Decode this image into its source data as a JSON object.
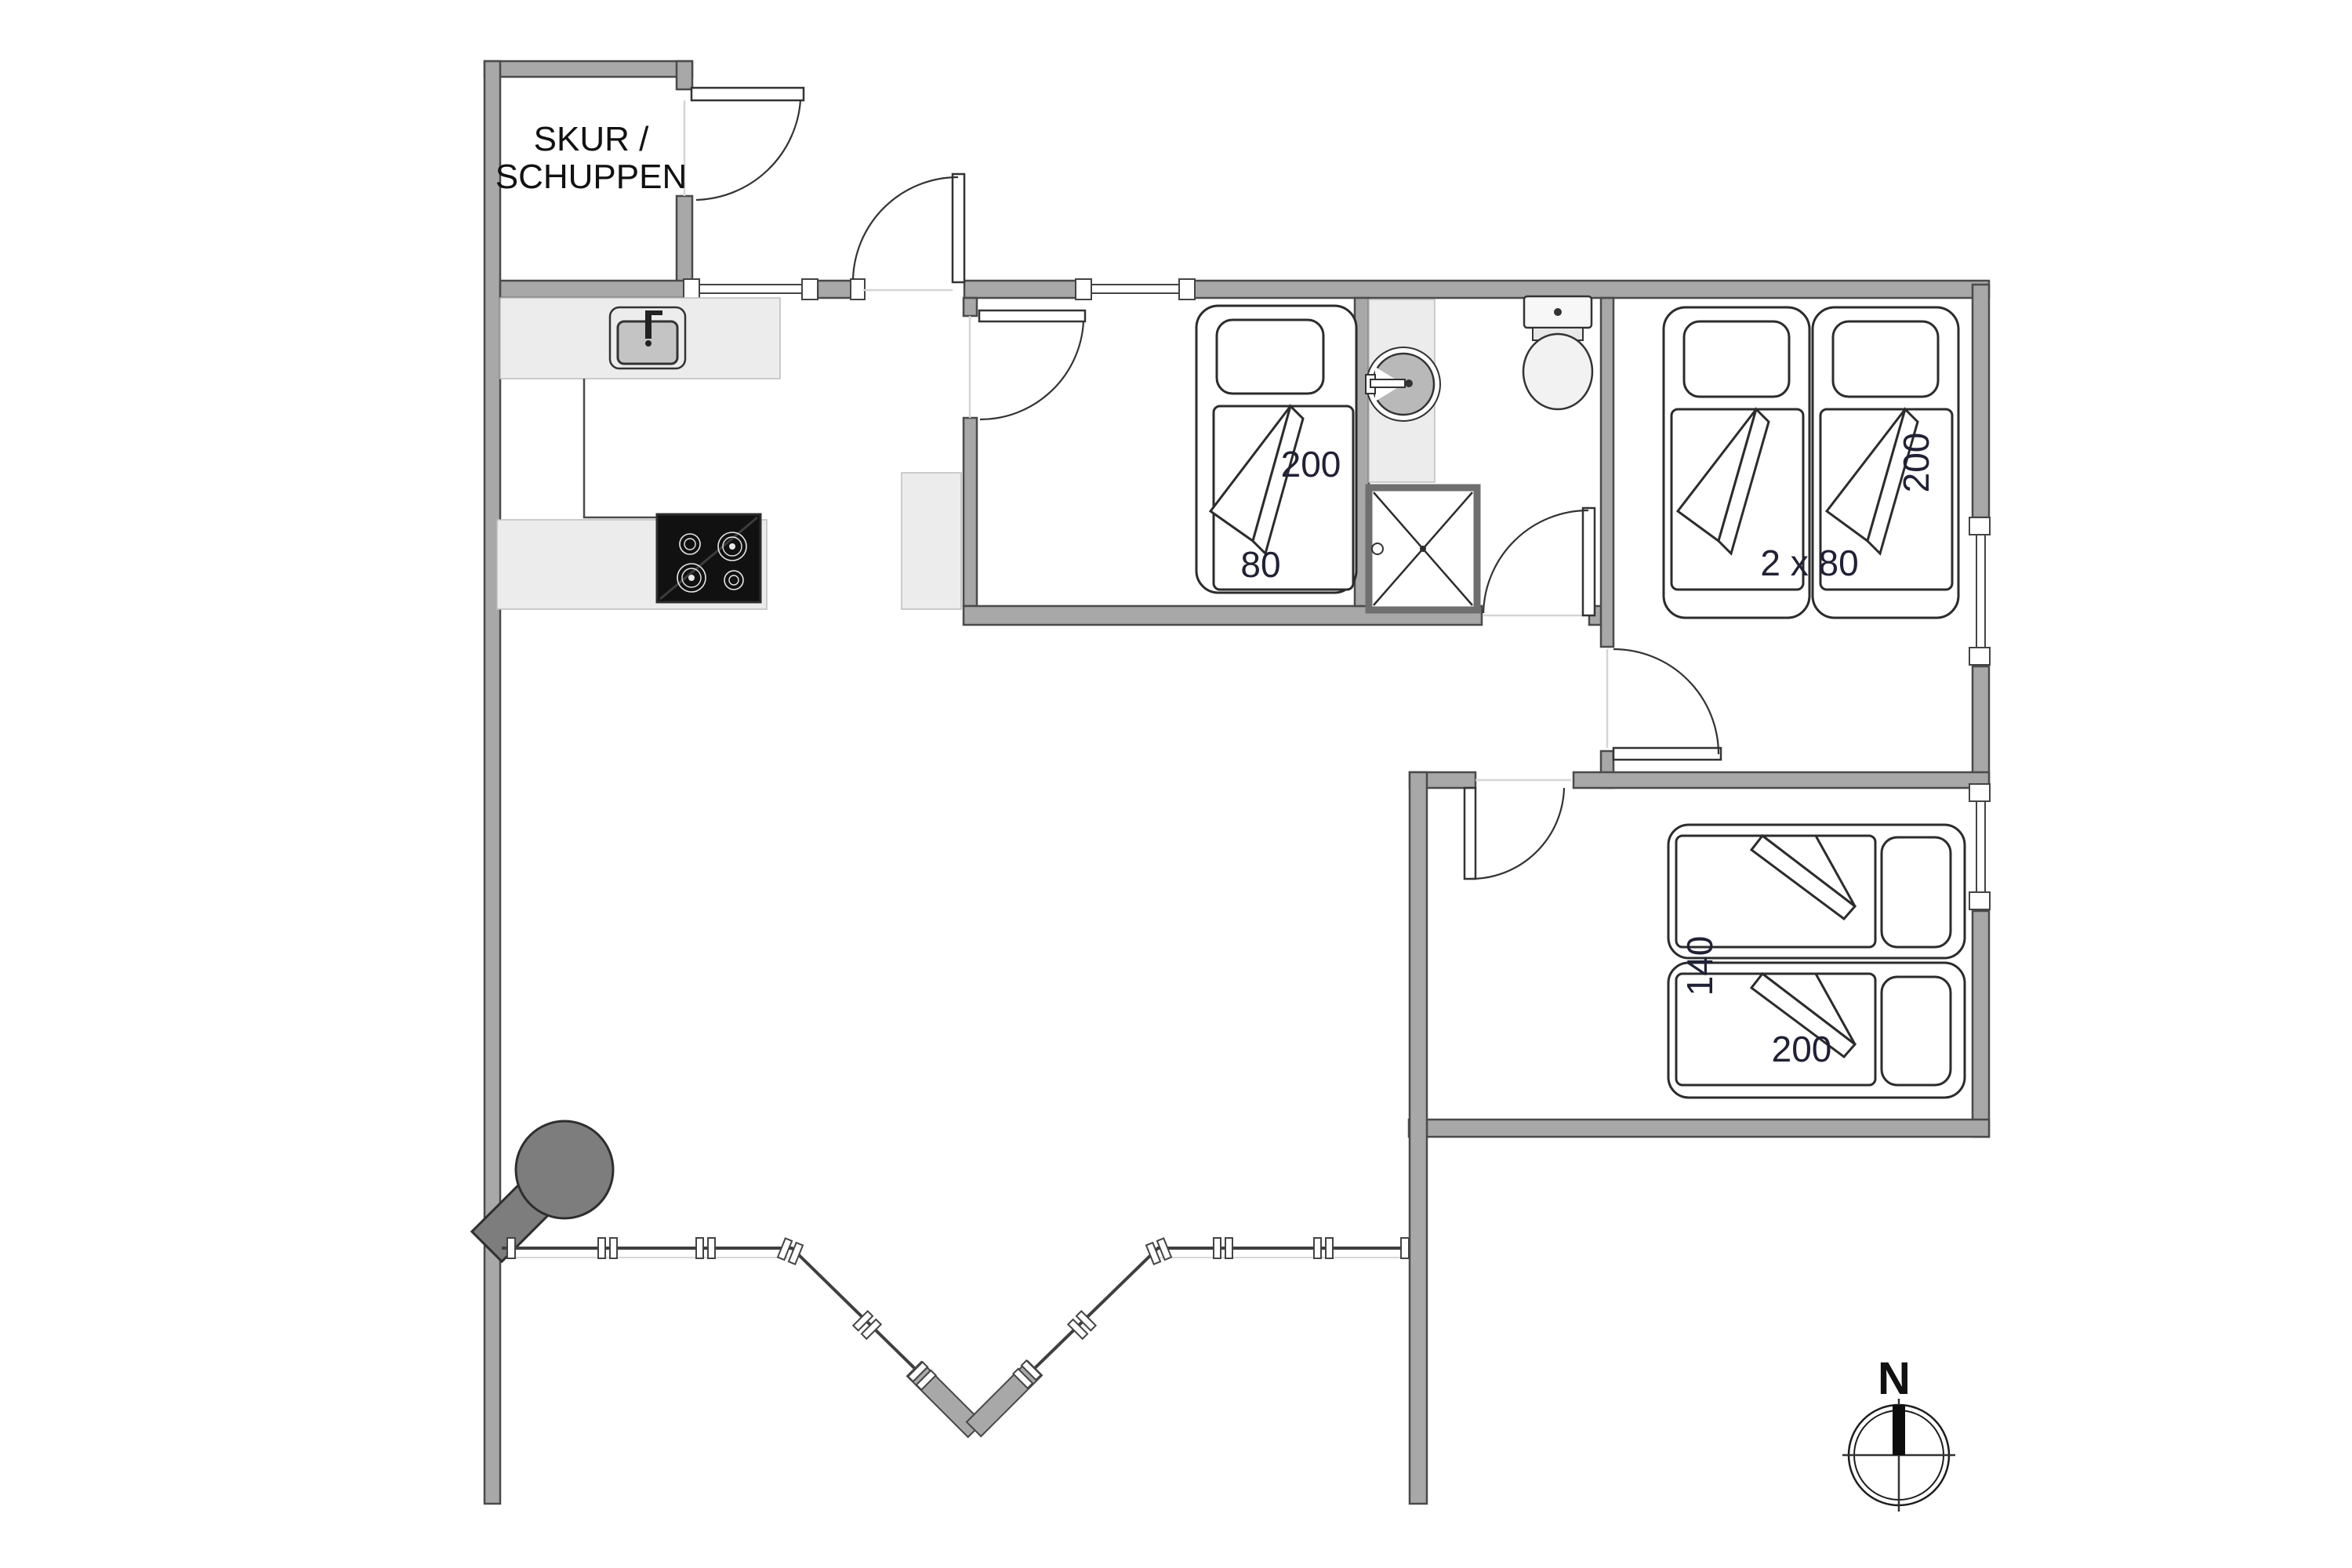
{
  "page": {
    "title": "Holiday house floor plan",
    "background": "#ffffff"
  },
  "labels": {
    "shed_line1": "SKUR /",
    "shed_line2": "SCHUPPEN",
    "single_bed_length": "200",
    "single_bed_width": "80",
    "twin_beds_size": "2 x 80",
    "twin_beds_length": "200",
    "double_bed_width": "140",
    "double_bed_length": "200",
    "compass_north": "N"
  },
  "colors": {
    "wall_fill": "#a8a8a8",
    "wall_outline": "#4a4a4a",
    "counter_fill": "#ececec",
    "fixture_gray": "#bdbdbd",
    "stove_black": "#111111",
    "wood_stove_gray": "#7d7d7d",
    "label_color": "#202036",
    "background": "#ffffff"
  },
  "icons": {
    "kitchen_sink": "sink-icon",
    "cooktop": "stove-icon",
    "wood_stove": "wood-stove-icon",
    "washbasin": "washbasin-icon",
    "toilet": "toilet-icon",
    "shower": "shower-icon",
    "compass": "compass-rose-icon"
  }
}
